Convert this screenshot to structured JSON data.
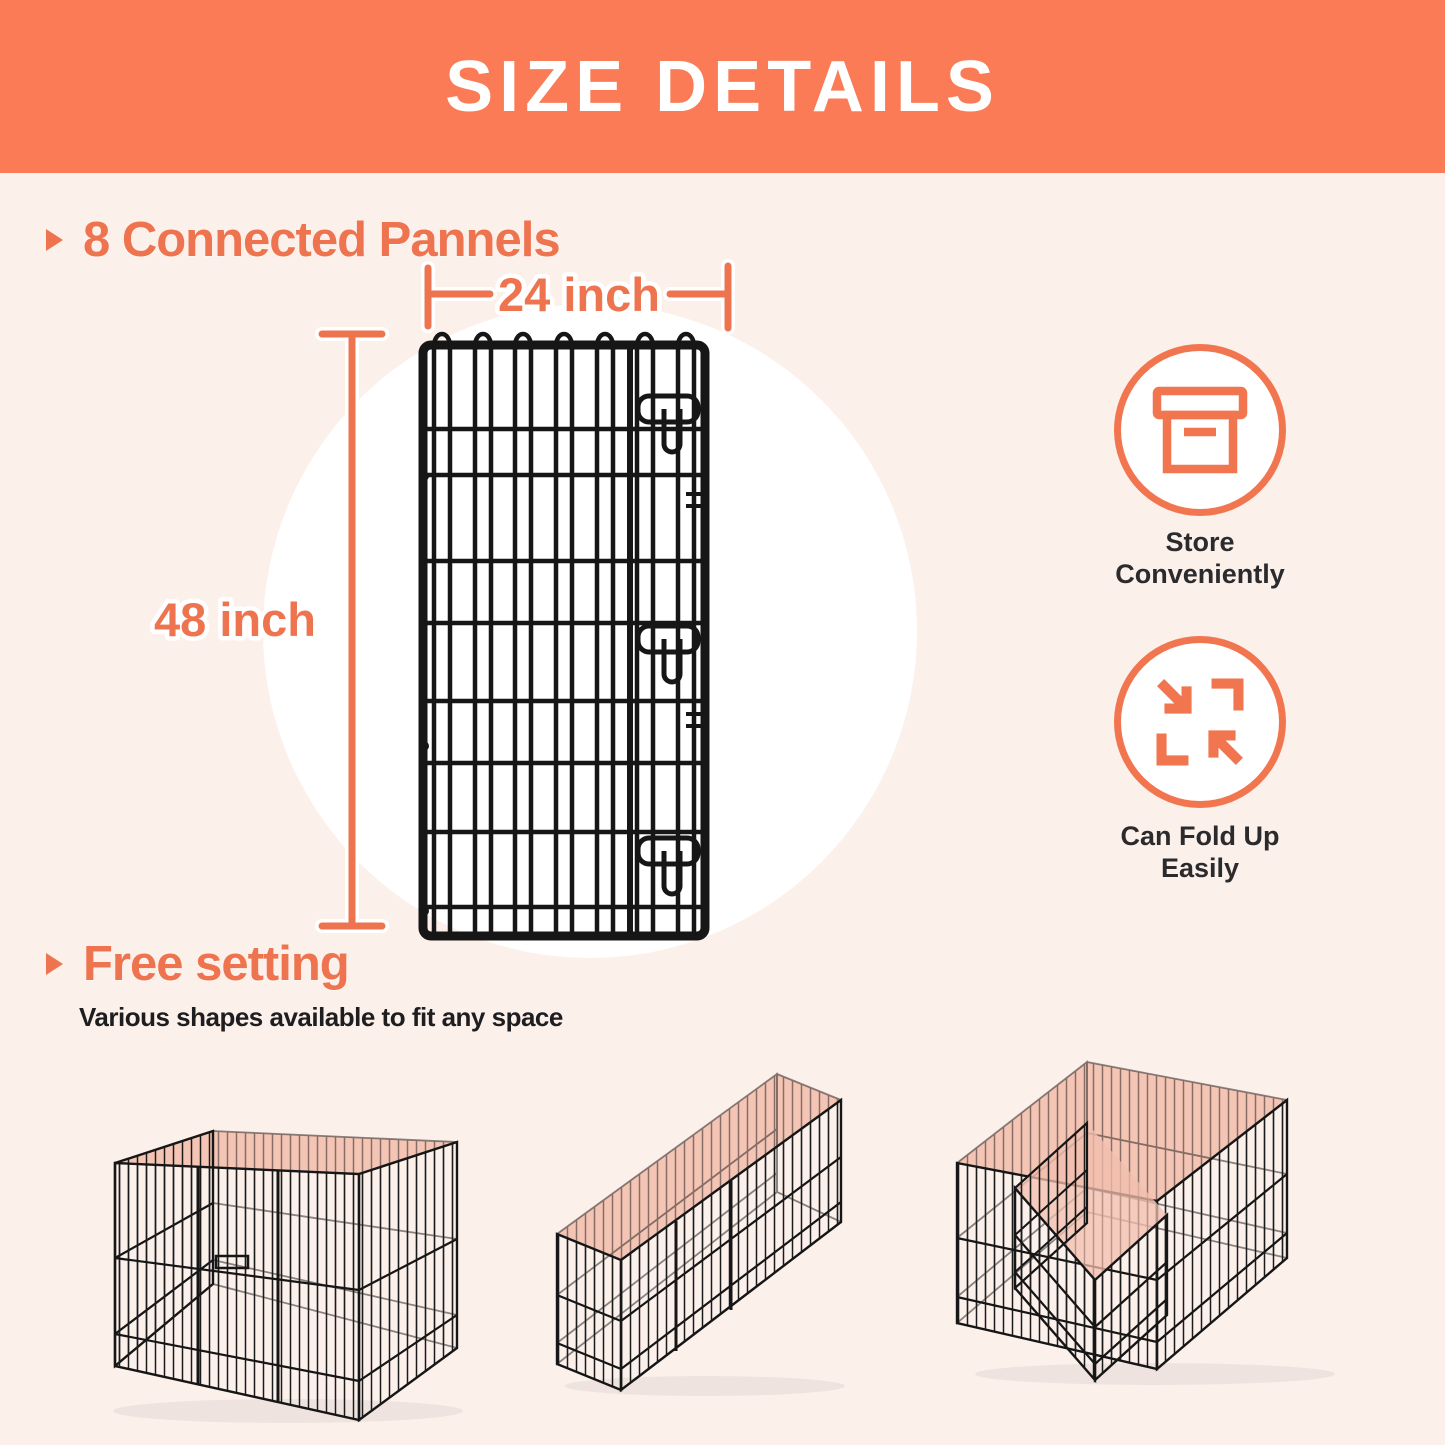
{
  "header": {
    "title": "SIZE DETAILS"
  },
  "sections": {
    "panels": {
      "title": "8 Connected Pannels"
    },
    "free_setting": {
      "title": "Free setting",
      "subtitle": "Various shapes available to fit any space"
    }
  },
  "dimensions": {
    "width_label": "24 inch",
    "height_label": "48 inch"
  },
  "features": [
    {
      "icon": "storage-box-icon",
      "line1": "Store",
      "line2": "Conveniently"
    },
    {
      "icon": "fold-arrows-icon",
      "line1": "Can Fold Up",
      "line2": "Easily"
    }
  ],
  "shapes": {
    "icons": [
      "square-pen-icon",
      "rectangle-pen-icon",
      "l-shape-pen-icon"
    ]
  },
  "colors": {
    "accent": "#EE7450",
    "header_bg": "#FA7B55",
    "background": "#FCF0EB",
    "text_dark": "#2B2B2E",
    "wire": "#161616",
    "pen_top_pink": "#F3BFAE",
    "circle_white": "#FFFFFF"
  }
}
